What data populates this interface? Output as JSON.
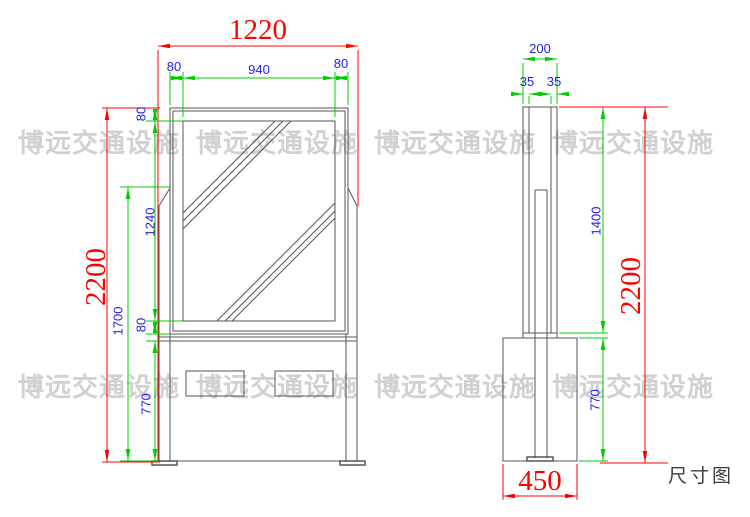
{
  "caption": "尺寸图",
  "watermark": {
    "text": "博远交通设施"
  },
  "colors": {
    "overall_dim_red": "#ff0000",
    "detail_dim_green": "#00cc00",
    "dim_value_blue": "#2222ee",
    "drawing_line_gray": "#555555",
    "watermark_gray": "#c9c9c9",
    "caption_gray": "#3d3d3d"
  },
  "front_view": {
    "dim_overall_width": "1220",
    "dim_frame_left": "80",
    "dim_glass_width": "940",
    "dim_frame_right": "80",
    "dim_overall_height": "2200",
    "dim_frame_top": "80",
    "dim_glass_height": "1240",
    "dim_body_height": "1700",
    "dim_frame_bottom": "80",
    "dim_base_height": "770"
  },
  "side_view": {
    "dim_depth": "200",
    "dim_wall_front": "35",
    "dim_wall_back": "35",
    "dim_box_height": "1400",
    "dim_overall_height": "2200",
    "dim_base_height": "770",
    "dim_base_depth": "450"
  }
}
